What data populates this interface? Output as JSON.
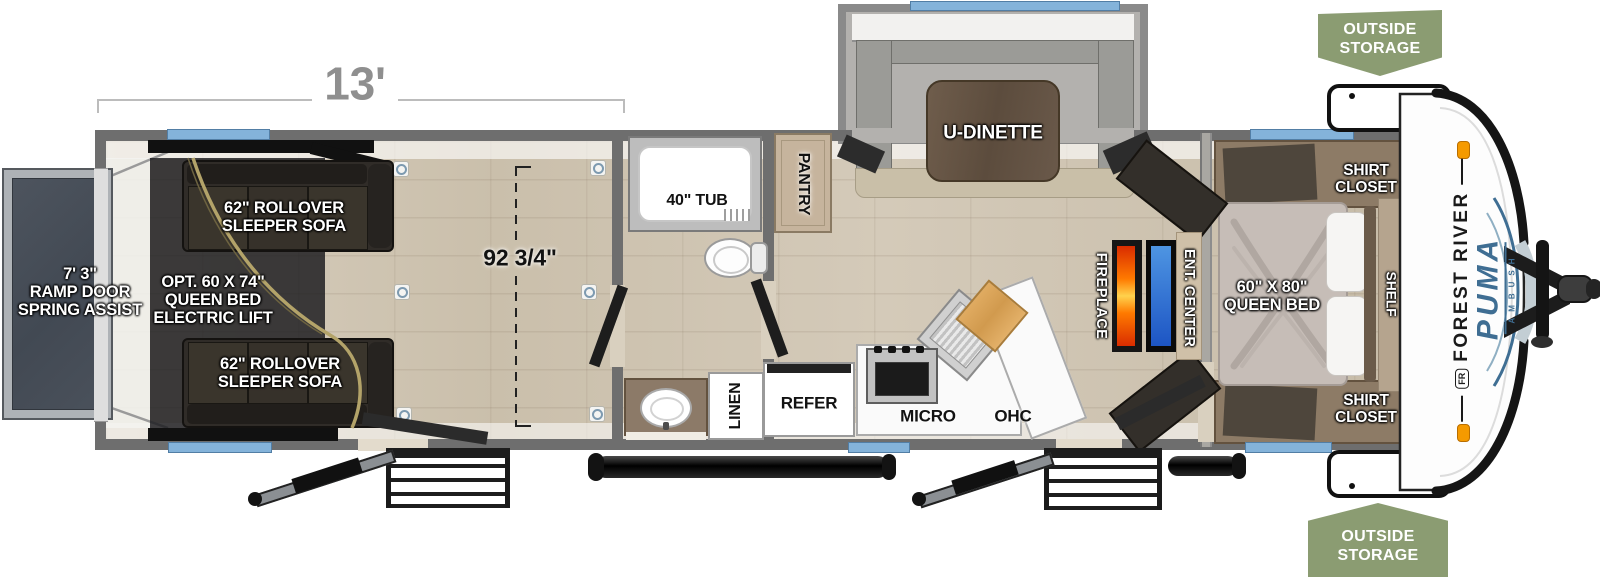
{
  "diagram_type": "travel-trailer floorplan (toy hauler)",
  "dimensions": {
    "garage_length": "13'",
    "garage_width": "92 3/4\""
  },
  "labels": {
    "ramp": "7' 3\"\nRAMP DOOR\nSPRING ASSIST",
    "sofa_top": "62\" ROLLOVER\nSLEEPER SOFA",
    "sofa_bottom": "62\" ROLLOVER\nSLEEPER SOFA",
    "bed_lift": "OPT. 60 X 74\"\nQUEEN BED\nELECTRIC LIFT",
    "tub": "40\" TUB",
    "pantry": "PANTRY",
    "linen": "LINEN",
    "refer": "REFER",
    "micro": "MICRO",
    "ohc": "OHC",
    "u_dinette": "U-DINETTE",
    "fireplace": "FIREPLACE",
    "ent_center": "ENT. CENTER",
    "queen_bed": "60\" X 80\"\nQUEEN BED",
    "shelf": "SHELF",
    "shirt_closet_top": "SHIRT\nCLOSET",
    "shirt_closet_bottom": "SHIRT\nCLOSET",
    "outside_storage_top": "OUTSIDE\nSTORAGE",
    "outside_storage_bottom": "OUTSIDE\nSTORAGE"
  },
  "brand": {
    "monogram": "FR",
    "maker": "FOREST RIVER",
    "model": "PUMA",
    "trim": "AMBUSH"
  },
  "colors": {
    "wall_gray": "#6e6e6e",
    "window_blue": "#84b3da",
    "badge_green": "#8b9c72",
    "floor_beige": "#cfc5b3",
    "ramp_slate": "#485059",
    "brand_blue": "#3f6e93",
    "flame_orange": "#ff7a00",
    "tv_blue": "#2f6fd0"
  }
}
